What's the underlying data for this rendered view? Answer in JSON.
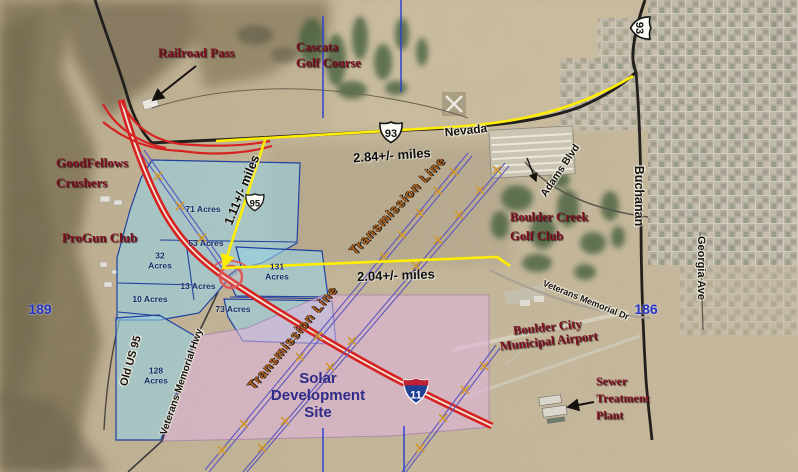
{
  "region_labels": {
    "railroad_pass": "Railroad Pass",
    "cascata_golf": [
      "Cascata",
      "Golf Course"
    ],
    "goodfellows": [
      "GoodFellows",
      "Crushers"
    ],
    "progun_club": "ProGun Club",
    "boulder_creek": [
      "Boulder Creek",
      "Golf Club"
    ],
    "airport": [
      "Boulder City",
      "Municipal Airport"
    ],
    "sewer_plant": [
      "Sewer",
      "Treatment",
      "Plant"
    ],
    "solar_site": [
      "Solar",
      "Development",
      "Site"
    ]
  },
  "road_labels": {
    "nevada": "Nevada",
    "adams_blvd": "Adams Blvd",
    "buchanan": "Buchanan",
    "georgia_ave": "Georgia Ave",
    "veterans_memorial_dr": "Veterans Memorial Dr",
    "veterans_memorial_hwy": "Veterans Memorial Hwy",
    "old_us_95": "Old US 95"
  },
  "transmission": {
    "label": "Transmission Line"
  },
  "measurements": {
    "along_hwy93": "2.84+/- miles",
    "site_to_east": "2.04+/- miles",
    "site_to_hwy93": "1.11+/- miles"
  },
  "route_shields": {
    "us93": "93",
    "us95": "95",
    "i11": "11"
  },
  "section_numbers": {
    "west": "189",
    "east": "186"
  },
  "parcels": {
    "p71": "71 Acres",
    "p53": "53 Acres",
    "p32": [
      "32",
      "Acres"
    ],
    "p10": "10 Acres",
    "p13": "13 Acres",
    "p131": [
      "131",
      "Acres"
    ],
    "p73": "73 Acres",
    "p128": [
      "128",
      "Acres"
    ]
  },
  "colors": {
    "parcel_blue_fill": "#9fd2e6",
    "parcel_border": "#1e3fa0",
    "site_pink_fill": "#e4bce4",
    "highway_red": "#d92020",
    "measurement_yellow": "#ffee00",
    "section_line_blue": "#2b3fd0",
    "place_label_maroon": "#7d1020",
    "transmission_orange": "#b06018",
    "section_number_blue": "#2633c0"
  }
}
